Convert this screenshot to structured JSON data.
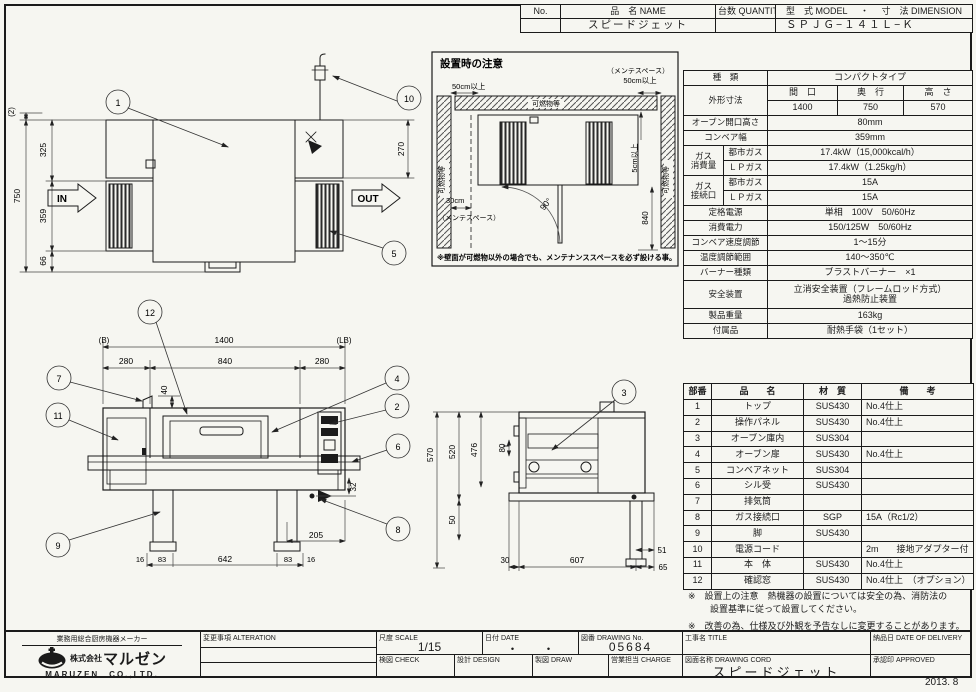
{
  "colors": {
    "paper": "#f6f6f1",
    "ink": "#1b1b1b"
  },
  "header": {
    "no_label": "No.",
    "name_label": "品　名 NAME",
    "qty_label": "台数 QUANTITY",
    "model_label": "型　式 MODEL",
    "dot": "・",
    "dim_label": "寸　法 DIMENSION",
    "name_value": "スピードジェット",
    "model_value": "ＳＰＪＧ−１４１Ｌ−Ｋ"
  },
  "spec": {
    "type_label": "種　類",
    "type_value": "コンパクトタイプ",
    "dims_label": "外形寸法",
    "w_label": "間　口",
    "d_label": "奥　行",
    "h_label": "高　さ",
    "w": "1400",
    "d": "750",
    "h": "570",
    "open_h_label": "オーブン開口高さ",
    "open_h": "80mm",
    "belt_w_label": "コンベア幅",
    "belt_w": "359mm",
    "gas_use_label1": "ガス",
    "gas_use_label2": "消費量",
    "city_label1": "都市ガス",
    "lp_label1": "ＬＰガス",
    "city_use": "17.4kW（15,000kcal/h）",
    "lp_use": "17.4kW（1.25kg/h）",
    "gas_conn_label1": "ガス",
    "gas_conn_label2": "接続口",
    "city_label2": "都市ガス",
    "lp_label2": "ＬＰガス",
    "conn_city": "15A",
    "conn_lp": "15A",
    "power_label": "定格電源",
    "power": "単相　100V　50/60Hz",
    "consumption_label": "消費電力",
    "consumption": "150/125W　50/60Hz",
    "speed_label": "コンベア速度調節",
    "speed": "1〜15分",
    "temp_label": "温度調節範囲",
    "temp": "140〜350℃",
    "burner_label": "バーナー種類",
    "burner": "ブラストバーナー　×1",
    "safety_label": "安全装置",
    "safety1": "立消安全装置（フレームロッド方式）",
    "safety2": "過熱防止装置",
    "weight_label": "製品重量",
    "weight": "163kg",
    "acc_label": "付属品",
    "acc": "耐熱手袋（1セット）"
  },
  "parts": {
    "headers": [
      "部番",
      "品　　名",
      "材　質",
      "備　　考"
    ],
    "rows": [
      [
        "1",
        "トップ",
        "SUS430",
        "No.4仕上"
      ],
      [
        "2",
        "操作パネル",
        "SUS430",
        "No.4仕上"
      ],
      [
        "3",
        "オーブン庫内",
        "SUS304",
        ""
      ],
      [
        "4",
        "オーブン扉",
        "SUS430",
        "No.4仕上"
      ],
      [
        "5",
        "コンベアネット",
        "SUS304",
        ""
      ],
      [
        "6",
        "シル受",
        "SUS430",
        ""
      ],
      [
        "7",
        "排気筒",
        "",
        ""
      ],
      [
        "8",
        "ガス接続口",
        "SGP",
        "15A（Rc1/2）"
      ],
      [
        "9",
        "脚",
        "SUS430",
        ""
      ],
      [
        "10",
        "電源コード",
        "",
        "2m　　接地アダプター付"
      ],
      [
        "11",
        "本　体",
        "SUS430",
        "No.4仕上"
      ],
      [
        "12",
        "確認窓",
        "SUS430",
        "No.4仕上　（オプション）"
      ]
    ]
  },
  "notes": {
    "note1a": "※　設置上の注意　熱機器の設置については安全の為、消防法の",
    "note1b": "設置基準に従って設置してください。",
    "note2": "※　改善の為、仕様及び外観を予告なしに変更することがあります。"
  },
  "plan": {
    "balloon_1": "1",
    "balloon_10": "10",
    "balloon_5": "5",
    "dim_2": "(2)",
    "dim_325": "325",
    "dim_750": "750",
    "dim_359": "359",
    "dim_66": "66",
    "dim_270": "270",
    "in_label": "IN",
    "out_label": "OUT",
    "x_mark": "×"
  },
  "install": {
    "title": "設置時の注意",
    "dim_50_left": "50cm以上",
    "maint_right": "（メンテスペース）",
    "dim_50_right": "50cm以上",
    "dim_5": "5cm以上",
    "wall_top": "可燃物等",
    "wall_left": "可燃物等",
    "wall_right": "可燃物等",
    "dim_30": "30cm",
    "maint_left": "（メンテスペース）",
    "angle_90": "90°",
    "dim_840": "840",
    "footnote": "※壁面が可燃物以外の場合でも、メンテナンススペースを必ず設ける事。"
  },
  "front": {
    "datum_b": "(B)",
    "datum_lb": "(LB)",
    "dim_1400": "1400",
    "dim_280l": "280",
    "dim_840": "840",
    "dim_280r": "280",
    "dim_40": "40",
    "dim_32": "32",
    "dim_205": "205",
    "dim_16l": "16",
    "dim_83l": "83",
    "dim_642": "642",
    "dim_83r": "83",
    "dim_16r": "16",
    "balloon_12": "12",
    "balloon_7": "7",
    "balloon_11": "11",
    "balloon_4": "4",
    "balloon_2": "2",
    "balloon_6": "6",
    "balloon_8": "8",
    "balloon_9": "9"
  },
  "side": {
    "dim_570": "570",
    "dim_520": "520",
    "dim_476": "476",
    "dim_80": "80",
    "dim_50": "50",
    "dim_30": "30",
    "dim_607": "607",
    "dim_65": "65",
    "dim_51": "51",
    "balloon_3": "3"
  },
  "titleblock": {
    "maker_tagline": "業務用総合厨房機器メーカー",
    "company_prefix": "株式会社",
    "company": "マルゼン",
    "company_en": "MARUZEN　CO.,LTD.",
    "alteration_label": "変更事項 ALTERATION",
    "scale_label": "尺度 SCALE",
    "scale_value": "1/15",
    "date_label": "日付 DATE",
    "date_value": "・　　・",
    "dwgno_label": "図番 DRAWING No.",
    "dwgno_value": "05684",
    "title_label": "工事名 TITLE",
    "delivery_label": "納品日 DATE OF DELIVERY",
    "check_label": "検図 CHECK",
    "design_label": "設計 DESIGN",
    "draw_label": "製図 DRAW",
    "charge_label": "営業担当 CHARGE",
    "dwgname_label": "図面名称 DRAWING CORD",
    "dwgname_value": "スピードジェット",
    "approved_label": "承認印 APPROVED"
  },
  "footer": {
    "issue_date": "2013. 8"
  }
}
